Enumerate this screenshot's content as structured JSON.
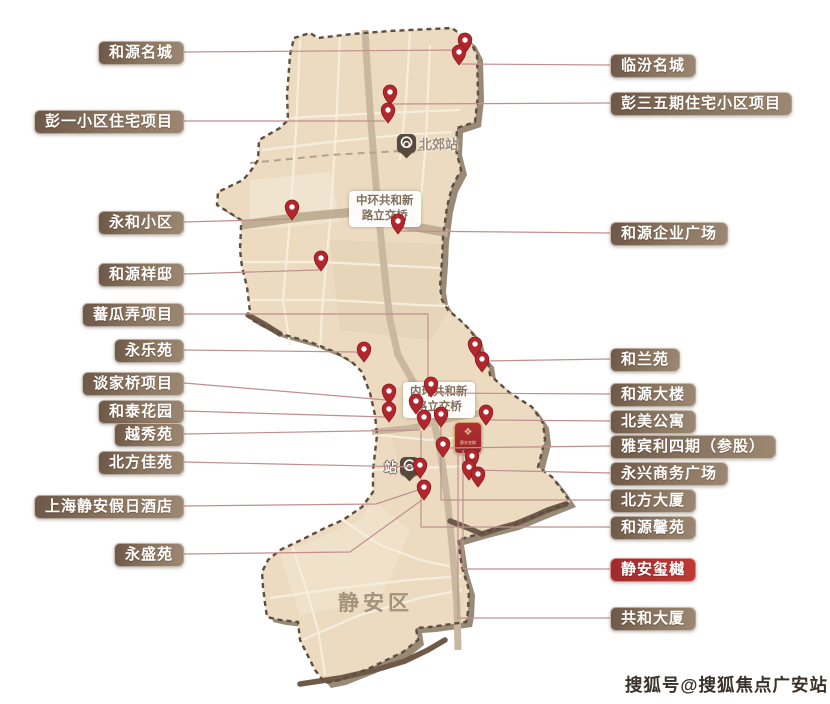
{
  "watermark": "搜狐号@搜狐焦点广安站",
  "colors": {
    "pin_red": "#b2272d",
    "pin_stroke": "#871b20",
    "connector": "#c18f8f",
    "label_brown_dark": "#6d5848",
    "label_brown_light": "#9c8872",
    "highlight_red": "#b03034",
    "map_fill": "#ecdbc1",
    "boundary": "#5d4e3f"
  },
  "map": {
    "district_label": "静安区",
    "north_station_name": "北郊站",
    "south_station_name": "站",
    "ring_mid_line1": "中环共和新",
    "ring_mid_line2": "路立交桥",
    "ring_inner_line1": "内环共和新",
    "ring_inner_line2": "路立交桥"
  },
  "logo_marker": {
    "emblem": "❖",
    "title": "静安玺樾"
  },
  "callouts": [
    {
      "text": "和源名城",
      "side": "left",
      "top": 41,
      "highlight": false,
      "line": [
        [
          184,
          52
        ],
        [
          462,
          50
        ]
      ]
    },
    {
      "text": "彭一小区住宅项目",
      "side": "left",
      "top": 110,
      "highlight": false,
      "line": [
        [
          184,
          121
        ],
        [
          385,
          121
        ]
      ]
    },
    {
      "text": "永和小区",
      "side": "left",
      "top": 211,
      "highlight": false,
      "line": [
        [
          184,
          222
        ],
        [
          290,
          219
        ]
      ]
    },
    {
      "text": "和源祥邸",
      "side": "left",
      "top": 263,
      "highlight": false,
      "line": [
        [
          184,
          274
        ],
        [
          319,
          270
        ]
      ]
    },
    {
      "text": "蕃瓜弄项目",
      "side": "left",
      "top": 303,
      "highlight": false,
      "line": [
        [
          184,
          314
        ],
        [
          428,
          314
        ],
        [
          428,
          385
        ]
      ]
    },
    {
      "text": "永乐苑",
      "side": "left",
      "top": 339,
      "highlight": false,
      "line": [
        [
          184,
          350
        ],
        [
          356,
          352
        ],
        [
          362,
          359
        ]
      ]
    },
    {
      "text": "谈家桥项目",
      "side": "left",
      "top": 372,
      "highlight": false,
      "line": [
        [
          184,
          383
        ],
        [
          386,
          400
        ]
      ]
    },
    {
      "text": "和泰花园",
      "side": "left",
      "top": 400,
      "highlight": false,
      "line": [
        [
          184,
          411
        ],
        [
          385,
          417
        ]
      ]
    },
    {
      "text": "越秀苑",
      "side": "left",
      "top": 423,
      "highlight": false,
      "line": [
        [
          184,
          434
        ],
        [
          420,
          430
        ]
      ]
    },
    {
      "text": "北方佳苑",
      "side": "left",
      "top": 451,
      "highlight": false,
      "line": [
        [
          184,
          462
        ],
        [
          414,
          467
        ]
      ]
    },
    {
      "text": "上海静安假日酒店",
      "side": "left",
      "top": 495,
      "highlight": false,
      "line": [
        [
          184,
          506
        ],
        [
          376,
          504
        ],
        [
          418,
          490
        ]
      ]
    },
    {
      "text": "永盛苑",
      "side": "left",
      "top": 543,
      "highlight": false,
      "line": [
        [
          184,
          554
        ],
        [
          350,
          552
        ],
        [
          422,
          500
        ]
      ]
    },
    {
      "text": "临汾名城",
      "side": "right",
      "top": 54,
      "highlight": false,
      "line": [
        [
          461,
          64
        ],
        [
          610,
          65
        ]
      ]
    },
    {
      "text": "彭三五期住宅小区项目",
      "side": "right",
      "top": 92,
      "highlight": false,
      "line": [
        [
          393,
          104
        ],
        [
          610,
          103
        ]
      ]
    },
    {
      "text": "和源企业广场",
      "side": "right",
      "top": 222,
      "highlight": false,
      "line": [
        [
          401,
          231
        ],
        [
          610,
          233
        ]
      ]
    },
    {
      "text": "和兰苑",
      "side": "right",
      "top": 348,
      "highlight": false,
      "line": [
        [
          484,
          361
        ],
        [
          610,
          359
        ]
      ]
    },
    {
      "text": "和源大楼",
      "side": "right",
      "top": 383,
      "highlight": false,
      "line": [
        [
          434,
          393
        ],
        [
          610,
          394
        ]
      ]
    },
    {
      "text": "北美公寓",
      "side": "right",
      "top": 410,
      "highlight": false,
      "line": [
        [
          489,
          420
        ],
        [
          610,
          421
        ]
      ]
    },
    {
      "text": "雅宾利四期（参股）",
      "side": "right",
      "top": 435,
      "highlight": false,
      "line": [
        [
          446,
          448
        ],
        [
          610,
          446
        ]
      ]
    },
    {
      "text": "永兴商务广场",
      "side": "right",
      "top": 462,
      "highlight": false,
      "line": [
        [
          473,
          470
        ],
        [
          610,
          473
        ]
      ]
    },
    {
      "text": "北方大厦",
      "side": "right",
      "top": 489,
      "highlight": false,
      "line": [
        [
          441,
          427
        ],
        [
          441,
          500
        ],
        [
          610,
          500
        ]
      ]
    },
    {
      "text": "和源馨苑",
      "side": "right",
      "top": 516,
      "highlight": false,
      "line": [
        [
          421,
          431
        ],
        [
          421,
          527
        ],
        [
          610,
          527
        ]
      ]
    },
    {
      "text": "静安玺樾",
      "side": "right",
      "top": 558,
      "highlight": true,
      "line": [
        [
          463,
          450
        ],
        [
          463,
          569
        ],
        [
          610,
          569
        ]
      ]
    },
    {
      "text": "共和大厦",
      "side": "right",
      "top": 607,
      "highlight": false,
      "line": [
        [
          458,
          455
        ],
        [
          458,
          618
        ],
        [
          610,
          618
        ]
      ]
    }
  ],
  "pins": [
    [
      465,
      53
    ],
    [
      459,
      65
    ],
    [
      390,
      105
    ],
    [
      388,
      123
    ],
    [
      292,
      220
    ],
    [
      398,
      234
    ],
    [
      321,
      271
    ],
    [
      364,
      362
    ],
    [
      475,
      357
    ],
    [
      482,
      372
    ],
    [
      389,
      404
    ],
    [
      389,
      422
    ],
    [
      431,
      397
    ],
    [
      416,
      414
    ],
    [
      424,
      430
    ],
    [
      441,
      427
    ],
    [
      486,
      425
    ],
    [
      443,
      457
    ],
    [
      472,
      469
    ],
    [
      469,
      480
    ],
    [
      478,
      487
    ],
    [
      420,
      478
    ],
    [
      424,
      500
    ]
  ]
}
